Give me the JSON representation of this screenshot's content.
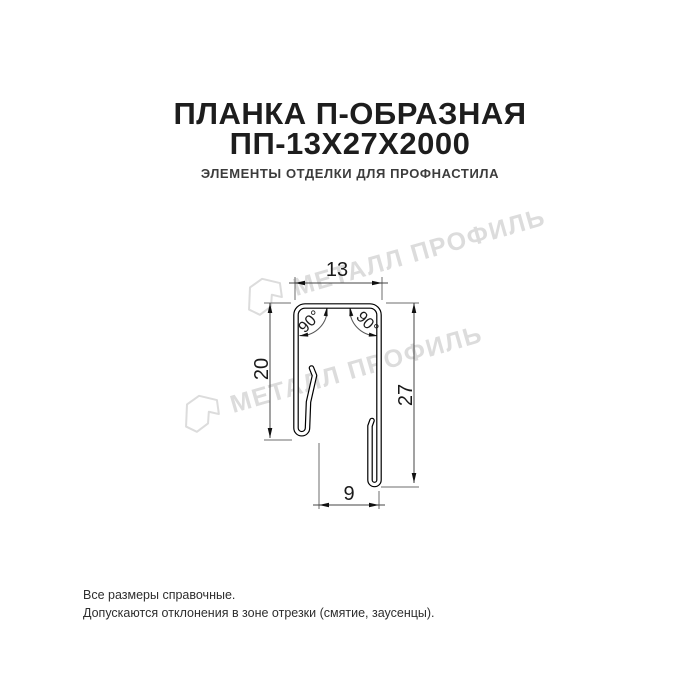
{
  "header": {
    "title_line1": "ПЛАНКА П-ОБРАЗНАЯ",
    "title_line2": "ПП-13Х27Х2000",
    "subtitle": "ЭЛЕМЕНТЫ ОТДЕЛКИ ДЛЯ ПРОФНАСТИЛА"
  },
  "watermark": {
    "text": "МЕТАЛЛ ПРОФИЛЬ",
    "color": "#dcdcdc"
  },
  "drawing": {
    "dim_top_width": "13",
    "dim_left_height": "20",
    "dim_right_height": "27",
    "dim_bottom_width": "9",
    "angle_left": "90°",
    "angle_right": "90°"
  },
  "footer": {
    "line1": "Все размеры справочные.",
    "line2": "Допускаются отклонения в зоне отрезки (смятие, заусенцы)."
  },
  "colors": {
    "title": "#1d1d1d",
    "subtitle": "#3c3c3c",
    "profile_line": "#000000",
    "dim_line": "#444444",
    "ext_line": "#6e6e6e",
    "watermark": "#dcdcdc",
    "background": "#ffffff"
  }
}
